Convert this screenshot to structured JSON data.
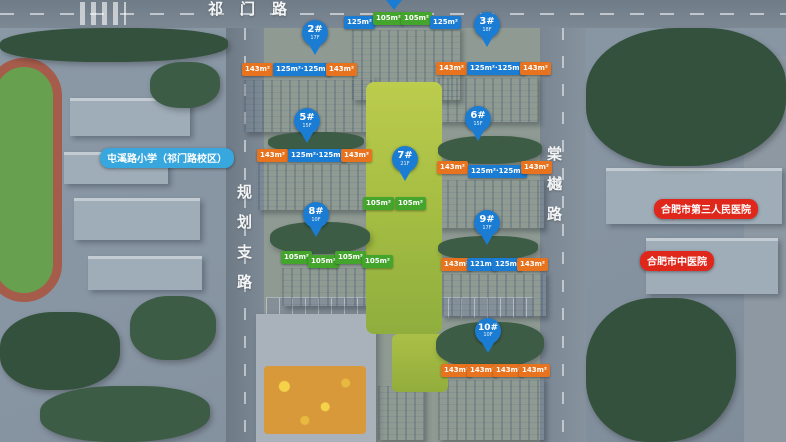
{
  "roads": {
    "top": "祁门路",
    "left": "规划支路",
    "right": "棠樾路"
  },
  "landmarks": {
    "school": "屯溪路小学（祁门路校区）",
    "hospital_north": "合肥市第三人民医院",
    "hospital_south": "合肥市中医院"
  },
  "buildings": [
    {
      "key": "north-tower",
      "pin": "",
      "floors": "",
      "tags": [
        {
          "text": "125m²",
          "color": "blue"
        },
        {
          "text": "105m²",
          "color": "green"
        },
        {
          "text": "105m²",
          "color": "green"
        },
        {
          "text": "125m²",
          "color": "blue"
        }
      ]
    },
    {
      "key": "2",
      "pin": "2#",
      "floors": "17F",
      "tags": [
        {
          "text": "143m²",
          "color": "orange"
        },
        {
          "text": "125m²·125m²",
          "color": "blue"
        },
        {
          "text": "143m²",
          "color": "orange"
        }
      ]
    },
    {
      "key": "3",
      "pin": "3#",
      "floors": "18F",
      "tags": [
        {
          "text": "143m²",
          "color": "orange"
        },
        {
          "text": "125m²·125m²",
          "color": "blue"
        },
        {
          "text": "143m²",
          "color": "orange"
        }
      ]
    },
    {
      "key": "5",
      "pin": "5#",
      "floors": "15F",
      "tags": [
        {
          "text": "143m²",
          "color": "orange"
        },
        {
          "text": "125m²·125m²",
          "color": "blue"
        },
        {
          "text": "143m²",
          "color": "orange"
        }
      ]
    },
    {
      "key": "6",
      "pin": "6#",
      "floors": "15F",
      "tags": [
        {
          "text": "143m²",
          "color": "orange"
        },
        {
          "text": "125m²·125m²",
          "color": "blue"
        },
        {
          "text": "143m²",
          "color": "orange"
        }
      ]
    },
    {
      "key": "7",
      "pin": "7#",
      "floors": "21F",
      "tags": [
        {
          "text": "105m²",
          "color": "green"
        },
        {
          "text": "105m²",
          "color": "green"
        }
      ]
    },
    {
      "key": "8",
      "pin": "8#",
      "floors": "10F",
      "tags": [
        {
          "text": "105m²",
          "color": "green"
        },
        {
          "text": "105m²",
          "color": "green"
        },
        {
          "text": "105m²",
          "color": "green"
        },
        {
          "text": "105m²",
          "color": "green"
        }
      ]
    },
    {
      "key": "9",
      "pin": "9#",
      "floors": "17F",
      "tags": [
        {
          "text": "143m²",
          "color": "orange"
        },
        {
          "text": "121m²",
          "color": "blue"
        },
        {
          "text": "125m²",
          "color": "blue"
        },
        {
          "text": "143m²",
          "color": "orange"
        }
      ]
    },
    {
      "key": "10",
      "pin": "10#",
      "floors": "10F",
      "tags": [
        {
          "text": "143m²",
          "color": "orange"
        },
        {
          "text": "143m²",
          "color": "orange"
        },
        {
          "text": "143m²",
          "color": "orange"
        },
        {
          "text": "143m²",
          "color": "orange"
        }
      ]
    }
  ],
  "colors": {
    "pin_blue": "#1b7cd3",
    "tag_blue": "#1b7cd3",
    "tag_orange": "#e7731e",
    "tag_green": "#44a52d",
    "bubble_blue": "#38a7de",
    "bubble_red": "#e0271b"
  }
}
